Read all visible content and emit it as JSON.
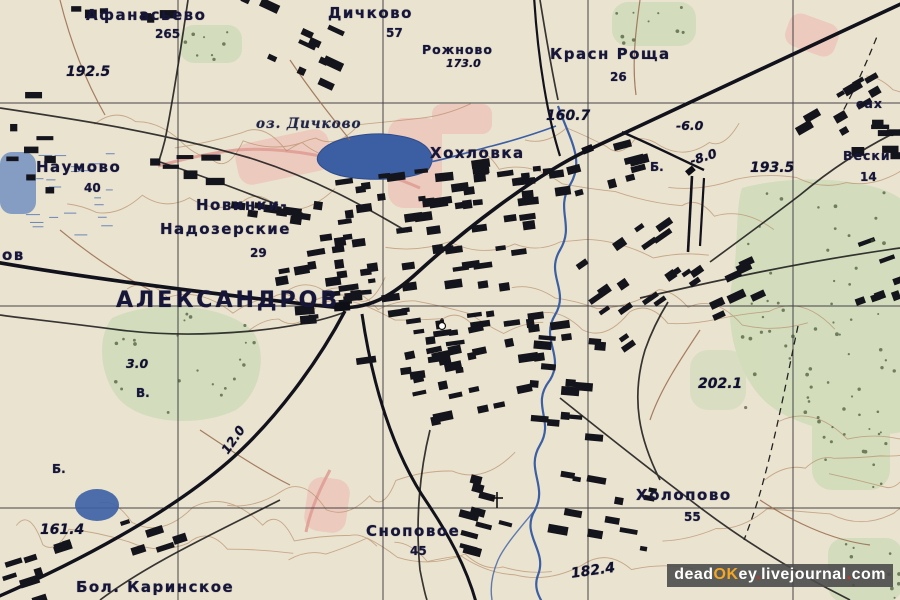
{
  "colors": {
    "paper": "#eae3cf",
    "contour": "#b5875f",
    "water": "#3a5fa8",
    "forest": "#cfdcb8",
    "pink": "#f0b0aa",
    "rail": "#12121c",
    "road": "#1c1c1c",
    "grid": "#33333a",
    "label": "#16163a",
    "spotc": "#101030",
    "wmwhite": "#ffffff",
    "wmorange": "#f5a623",
    "wmred": "#d03020"
  },
  "map": {
    "region": "Александров and surroundings (Soviet topographic map)",
    "labels": [
      {
        "t": "Афанасьево",
        "x": 86,
        "y": 6,
        "c": "town"
      },
      {
        "t": "265",
        "x": 155,
        "y": 27,
        "c": "num"
      },
      {
        "t": "192.5",
        "x": 66,
        "y": 64,
        "c": "spot"
      },
      {
        "t": "Дичково",
        "x": 328,
        "y": 4,
        "c": "town"
      },
      {
        "t": "57",
        "x": 386,
        "y": 26,
        "c": "num"
      },
      {
        "t": "Рожново",
        "x": 422,
        "y": 42,
        "c": "townsm"
      },
      {
        "t": "173.0",
        "x": 446,
        "y": 57,
        "c": "spotsm"
      },
      {
        "t": "Красн Роща",
        "x": 550,
        "y": 45,
        "c": "town"
      },
      {
        "t": "26",
        "x": 610,
        "y": 70,
        "c": "num"
      },
      {
        "t": "160.7",
        "x": 546,
        "y": 108,
        "c": "spot"
      },
      {
        "t": "-6.0",
        "x": 676,
        "y": 118,
        "c": "grade"
      },
      {
        "t": "сах",
        "x": 856,
        "y": 96,
        "c": "townsm"
      },
      {
        "t": "оз. Дичково",
        "x": 256,
        "y": 116,
        "c": "water"
      },
      {
        "t": "Хохловка",
        "x": 430,
        "y": 144,
        "c": "town"
      },
      {
        "t": "Б.",
        "x": 650,
        "y": 160,
        "c": "num"
      },
      {
        "t": "-8.0",
        "x": 688,
        "y": 154,
        "c": "grade",
        "r": -18
      },
      {
        "t": "193.5",
        "x": 750,
        "y": 160,
        "c": "spot"
      },
      {
        "t": "Вески",
        "x": 843,
        "y": 148,
        "c": "townsm"
      },
      {
        "t": "14",
        "x": 860,
        "y": 170,
        "c": "num"
      },
      {
        "t": "Наумово",
        "x": 36,
        "y": 158,
        "c": "town"
      },
      {
        "t": "40",
        "x": 84,
        "y": 181,
        "c": "num"
      },
      {
        "t": "Новинки-",
        "x": 196,
        "y": 196,
        "c": "town"
      },
      {
        "t": "Надозерские",
        "x": 160,
        "y": 220,
        "c": "town"
      },
      {
        "t": "29",
        "x": 250,
        "y": 246,
        "c": "num"
      },
      {
        "t": "ов",
        "x": 2,
        "y": 246,
        "c": "town"
      },
      {
        "t": "АЛЕКСАНДРОВ",
        "x": 116,
        "y": 288,
        "c": "city"
      },
      {
        "t": "3.0",
        "x": 126,
        "y": 356,
        "c": "grade"
      },
      {
        "t": "В.",
        "x": 136,
        "y": 386,
        "c": "num"
      },
      {
        "t": "Б.",
        "x": 52,
        "y": 462,
        "c": "num"
      },
      {
        "t": "12.0",
        "x": 218,
        "y": 448,
        "c": "grade",
        "r": -55
      },
      {
        "t": "202.1",
        "x": 698,
        "y": 376,
        "c": "spot"
      },
      {
        "t": "Холопово",
        "x": 636,
        "y": 486,
        "c": "town"
      },
      {
        "t": "55",
        "x": 684,
        "y": 510,
        "c": "num"
      },
      {
        "t": "Сноповое",
        "x": 366,
        "y": 522,
        "c": "town"
      },
      {
        "t": "45",
        "x": 410,
        "y": 544,
        "c": "num"
      },
      {
        "t": "161.4",
        "x": 40,
        "y": 522,
        "c": "spot"
      },
      {
        "t": "Бол. Каринское",
        "x": 76,
        "y": 578,
        "c": "town"
      },
      {
        "t": "182.4",
        "x": 570,
        "y": 566,
        "c": "spot",
        "r": -8
      }
    ],
    "watermark": {
      "parts": [
        {
          "text": "dead"
        },
        {
          "text": "OK"
        },
        {
          "text": "ey"
        },
        {
          "text": "."
        },
        {
          "text": "livejournal"
        },
        {
          "text": "."
        },
        {
          "text": "com"
        }
      ]
    }
  }
}
